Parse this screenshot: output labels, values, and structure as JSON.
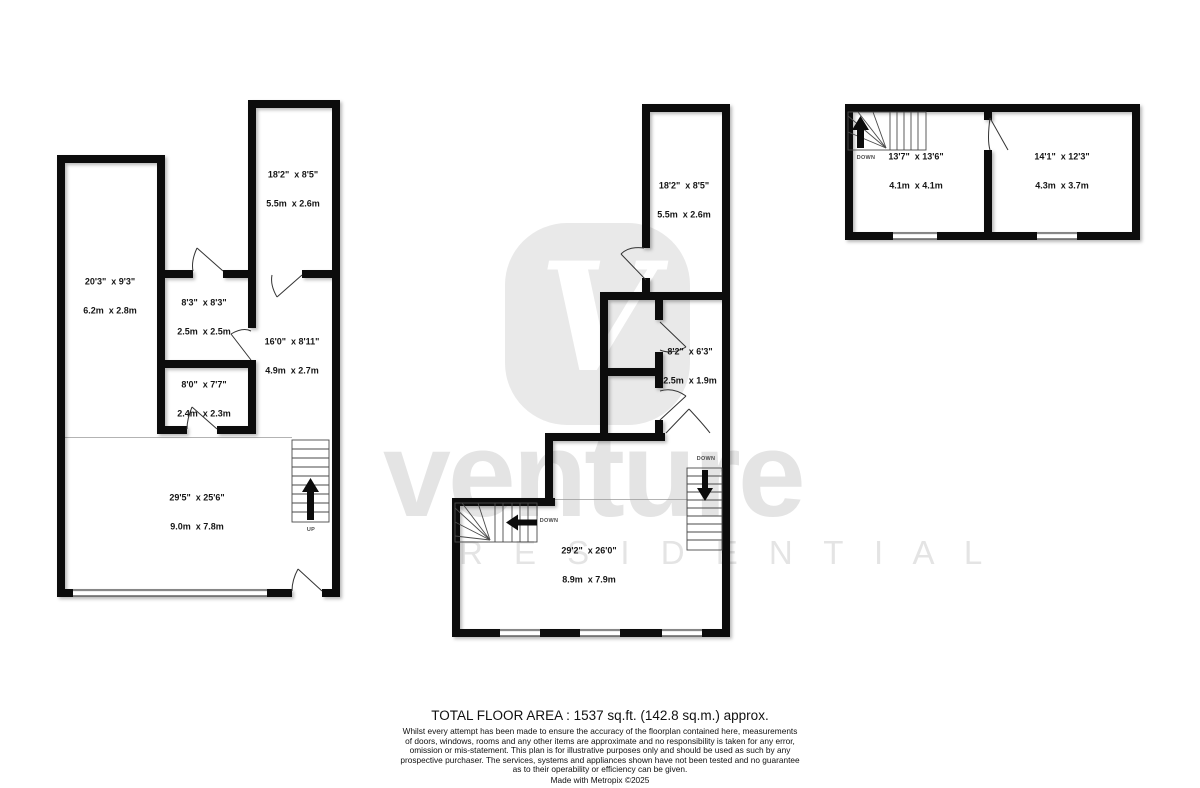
{
  "watermark": {
    "logo_letter": "V",
    "brand": "venture",
    "residential": "R E S I D E N T I A L",
    "gray": "#e9e9e9"
  },
  "colors": {
    "wall": "#0c0c0c",
    "background": "#ffffff"
  },
  "floors": [
    {
      "id": "left-plan",
      "rooms": [
        {
          "imperial": "18'2\"  x 8'5\"",
          "metric": "5.5m  x 2.6m"
        },
        {
          "imperial": "20'3\"  x 9'3\"",
          "metric": "6.2m  x 2.8m"
        },
        {
          "imperial": "8'3\"  x 8'3\"",
          "metric": "2.5m  x 2.5m"
        },
        {
          "imperial": "16'0\"  x 8'11\"",
          "metric": "4.9m  x 2.7m"
        },
        {
          "imperial": "8'0\"  x 7'7\"",
          "metric": "2.4m  x 2.3m"
        },
        {
          "imperial": "29'5\"  x 25'6\"",
          "metric": "9.0m  x 7.8m"
        }
      ],
      "stairs": [
        "UP"
      ]
    },
    {
      "id": "middle-plan",
      "rooms": [
        {
          "imperial": "18'2\"  x 8'5\"",
          "metric": "5.5m  x 2.6m"
        },
        {
          "imperial": "8'2\"  x 6'3\"",
          "metric": "2.5m  x 1.9m"
        },
        {
          "imperial": "29'2\"  x 26'0\"",
          "metric": "8.9m  x 7.9m"
        }
      ],
      "stairs": [
        "DOWN",
        "DOWN"
      ]
    },
    {
      "id": "right-plan",
      "rooms": [
        {
          "imperial": "13'7\"  x 13'6\"",
          "metric": "4.1m  x 4.1m"
        },
        {
          "imperial": "14'1\"  x 12'3\"",
          "metric": "4.3m  x 3.7m"
        }
      ],
      "stairs": [
        "DOWN"
      ]
    }
  ],
  "footer": {
    "total": "TOTAL FLOOR AREA : 1537 sq.ft. (142.8 sq.m.) approx.",
    "disclaimer": [
      "Whilst every attempt has been made to ensure the accuracy of the floorplan contained here, measurements",
      "of doors, windows, rooms and any other items are approximate and no responsibility is taken for any error,",
      "omission or mis-statement. This plan is for illustrative purposes only and should be used as such by any",
      "prospective purchaser. The services, systems and appliances shown have not been tested and no guarantee",
      "as to their operability or efficiency can be given."
    ],
    "credit": "Made with Metropix ©2025"
  }
}
